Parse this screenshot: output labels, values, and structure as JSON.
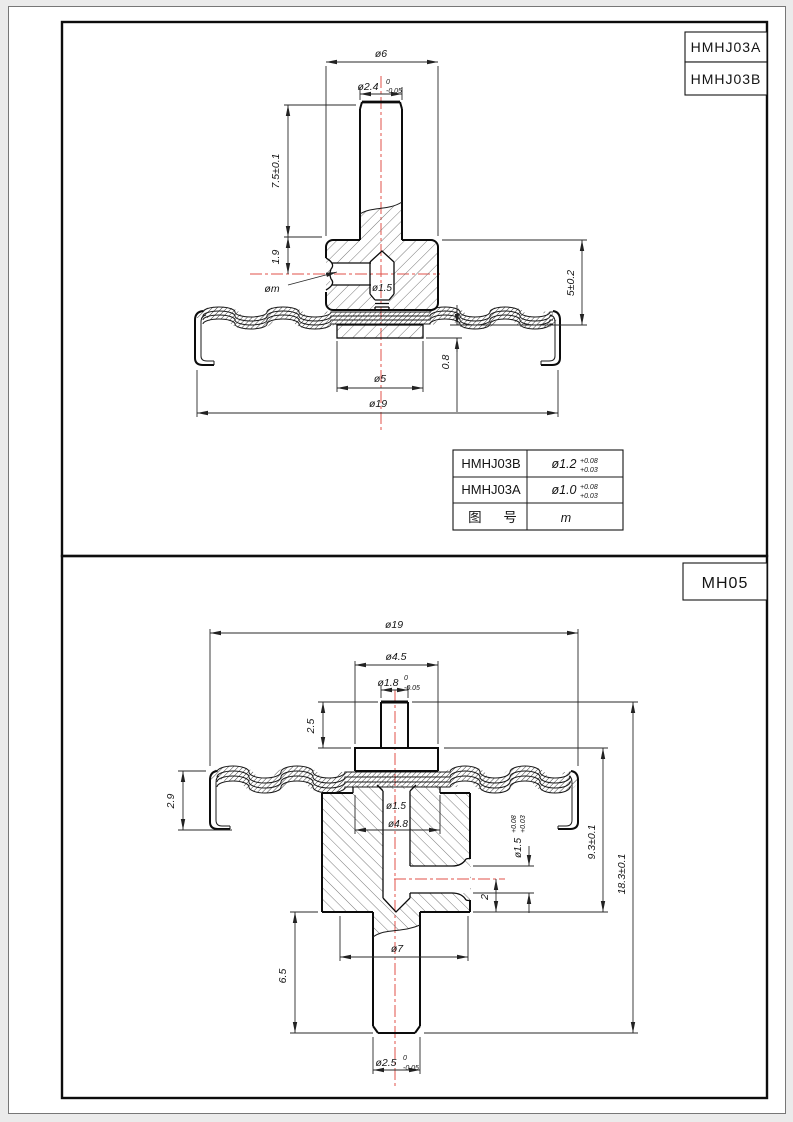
{
  "sheets": {
    "top": {
      "title_blocks": [
        "HMHJ03A",
        "HMHJ03B"
      ],
      "dims": {
        "dia6": "ø6",
        "dia24_main": "ø2.4",
        "dia24_sup": "0",
        "dia24_sub": "-0.05",
        "len75": "7.5±0.1",
        "len19": "1.9",
        "diam": "øm",
        "dia15": "ø1.5",
        "len5": "5±0.2",
        "len29": "2.9",
        "len08": "0.8",
        "dia5": "ø5",
        "dia19": "ø19"
      },
      "table": {
        "rows": [
          {
            "label": "HMHJ03B",
            "val": "ø1.2",
            "sup": "+0.08",
            "sub": "+0.03"
          },
          {
            "label": "HMHJ03A",
            "val": "ø1.0",
            "sup": "+0.08",
            "sub": "+0.03"
          },
          {
            "label": "图 号",
            "val": "m"
          }
        ]
      }
    },
    "bottom": {
      "title_blocks": [
        "MH05"
      ],
      "dims": {
        "dia19": "ø19",
        "dia45": "ø4.5",
        "dia18_main": "ø1.8",
        "dia18_sup": "0",
        "dia18_sub": "-0.05",
        "len25": "2.5",
        "len29": "2.9",
        "dia15": "ø1.5",
        "dia48": "ø4.8",
        "dia15s_main": "ø1.5",
        "dia15s_sup": "+0.08",
        "dia15s_sub": "+0.03",
        "len2": "2",
        "len93": "9.3±0.1",
        "len183": "18.3±0.1",
        "dia7": "ø7",
        "len65": "6.5",
        "dia25_main": "ø2.5",
        "dia25_sup": "0",
        "dia25_sub": "-0.05"
      }
    }
  },
  "colors": {
    "centerline": "#e0504a",
    "line": "#141414",
    "paper": "#ffffff",
    "margin_bg": "#ebebeb"
  }
}
